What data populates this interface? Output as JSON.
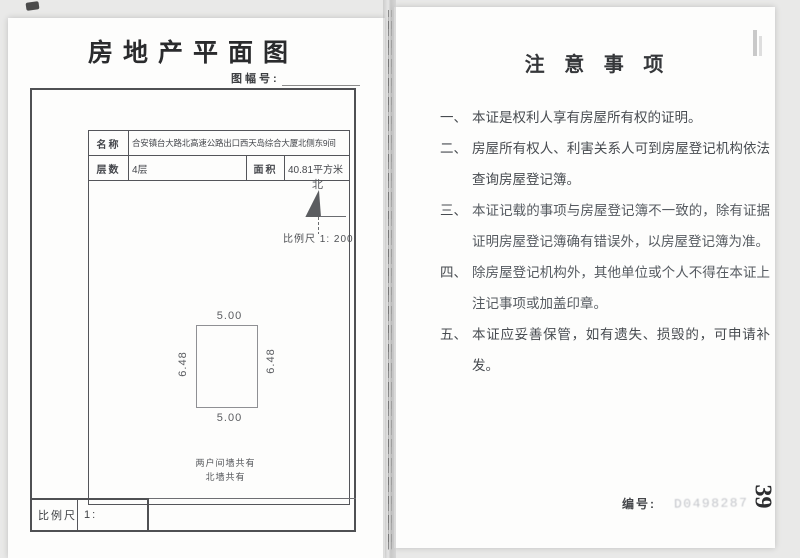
{
  "left_page": {
    "title": "房地产平面图",
    "sheet_no_label": "图幅号:",
    "table": {
      "name_label": "名称",
      "name_value": "合安镇台大路北高速公路出口西天岛综合大厦北侧东9间",
      "floors_label": "层数",
      "floors_value": "4层",
      "area_label": "面积",
      "area_value": "40.81平方米"
    },
    "compass_north_label": "北",
    "plan_scale_note": "比例尺 1: 200",
    "room": {
      "width_top": "5.00",
      "width_bottom": "5.00",
      "height_left": "6.48",
      "height_right": "6.48"
    },
    "wall_note_line1": "两户间墙共有",
    "wall_note_line2": "北墙共有",
    "scale_box_label": "比例尺",
    "scale_box_value": "1:"
  },
  "right_page": {
    "title": "注 意 事 项",
    "items": [
      {
        "num": "一、",
        "text": "本证是权利人享有房屋所有权的证明。"
      },
      {
        "num": "二、",
        "text": "房屋所有权人、利害关系人可到房屋登记机构依法查询房屋登记簿。"
      },
      {
        "num": "三、",
        "text": "本证记载的事项与房屋登记簿不一致的，除有证据证明房屋登记簿确有错误外，以房屋登记簿为准。"
      },
      {
        "num": "四、",
        "text": "除房屋登记机构外，其他单位或个人不得在本证上注记事项或加盖印章。"
      },
      {
        "num": "五、",
        "text": "本证应妥善保管，如有遗失、损毁的，可申请补发。"
      }
    ],
    "serial_label": "编号:",
    "serial_value": "D0498287",
    "page_number": "39"
  }
}
